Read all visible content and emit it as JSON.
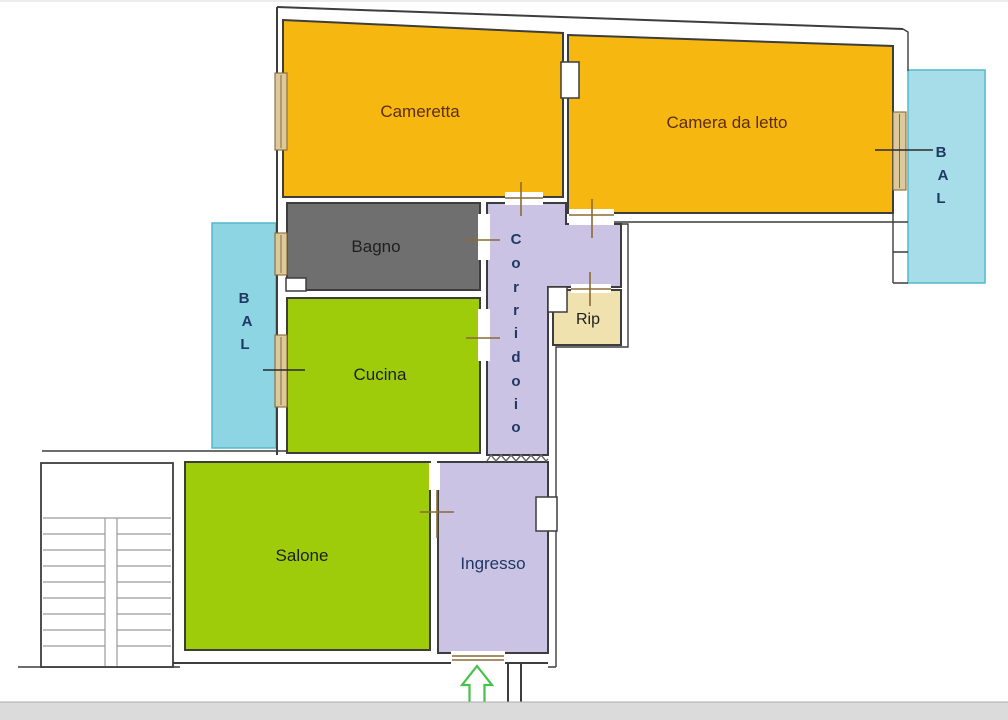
{
  "page": {
    "background": "#FFFFFF"
  },
  "rooms": {
    "cameretta": {
      "label": "Cameretta"
    },
    "camera_da_letto": {
      "label": "Camera da letto"
    },
    "bagno": {
      "label": "Bagno"
    },
    "cucina": {
      "label": "Cucina"
    },
    "salone": {
      "label": "Salone"
    },
    "ingresso": {
      "label": "Ingresso"
    },
    "rip": {
      "label": "Rip"
    },
    "corridoio": {
      "label": "Corridoio",
      "letters": [
        "C",
        "o",
        "r",
        "r",
        "i",
        "d",
        "o",
        "i",
        "o"
      ]
    },
    "balcone_left": {
      "label": "BAL",
      "letters": [
        "B",
        "A",
        "L"
      ]
    },
    "balcone_right": {
      "label": "BAL",
      "letters": [
        "B",
        "A",
        "L"
      ]
    }
  },
  "colors": {
    "bedroom_fill": "#F6B711",
    "living_kitchen_fill": "#9FCC0A",
    "hallway_fill": "#CBC3E4",
    "bathroom_fill": "#6F6F6F",
    "storage_fill": "#EFE2AE",
    "balcony_left_fill": "#8DD5E2",
    "balcony_right_fill": "#A7DDE8",
    "wall_stroke": "#3D3D3D",
    "door_mark": "#8A6A35",
    "window_fill": "#DCC99C",
    "bedroom_text": "#5C2E0E",
    "dark_text": "#1F1F1F",
    "navy_text": "#1F3864",
    "arrow_green": "#45C24A",
    "footer_strip_fill": "#DBDBDB"
  }
}
